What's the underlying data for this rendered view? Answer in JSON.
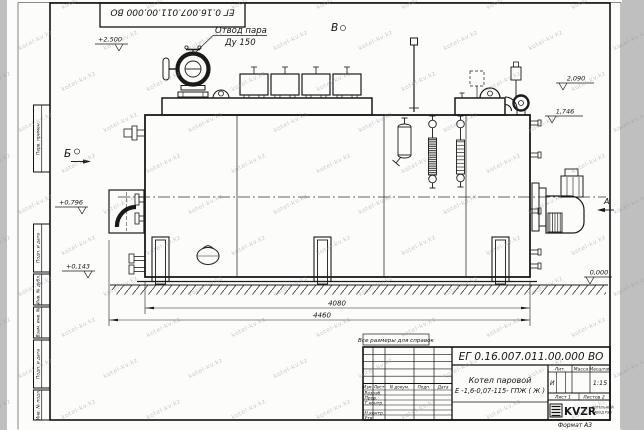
{
  "sheet": {
    "corner_doc_number": "ЕГ 0.16.007.011.00.000  ВО",
    "format_label": "Формат А3",
    "note": "Все размеры для справок",
    "watermark": "kotel-kv.kz"
  },
  "margin": {
    "labels": [
      "Перв. примен.",
      "Подп. и дата",
      "Инв. № дубл.",
      "Взам. инв. №",
      "Подп. и дата",
      "Инв. № подл."
    ]
  },
  "annotations": {
    "steam_outlet_line1": "Отвод пара",
    "steam_outlet_line2": "Ду 150",
    "view_b": "Б",
    "view_v": "В",
    "view_a": "А",
    "level_2500": "+2,500",
    "level_2090": "2,090",
    "level_1746": "1,746",
    "level_0796": "+0,796",
    "level_0143": "+0,143",
    "level_0000": "0,000",
    "dim_4080": "4080",
    "dim_4460": "4460"
  },
  "title_block": {
    "doc_number": "ЕГ 0.16.007.011.00.000  ВО",
    "product_name": "Котел паровой",
    "product_type": "Е -1,6-0,07-115- ГПЖ ( Ж )",
    "col_izm": "Изм.",
    "col_list": "Лист",
    "col_ndokum": "N докум.",
    "col_podp": "Подп.",
    "col_data": "Дата",
    "row_razrab": "Разраб.",
    "row_prov": "Пров.",
    "row_tkontr": "Т.контр.",
    "row_nkontr": "Н.контр.",
    "row_utv": "Утв.",
    "lit_header": "Лит.",
    "mass_header": "Масса",
    "scale_header": "Масштаб",
    "lit_value": "И",
    "scale_value": "1:15",
    "sheet_info": "Лист 1",
    "sheets_info": "Листов 2",
    "logo_text": "KVZR",
    "company_line1": "КОТЕЛЬНЫЙ",
    "company_line2": "ЗАВОД РЭП"
  }
}
